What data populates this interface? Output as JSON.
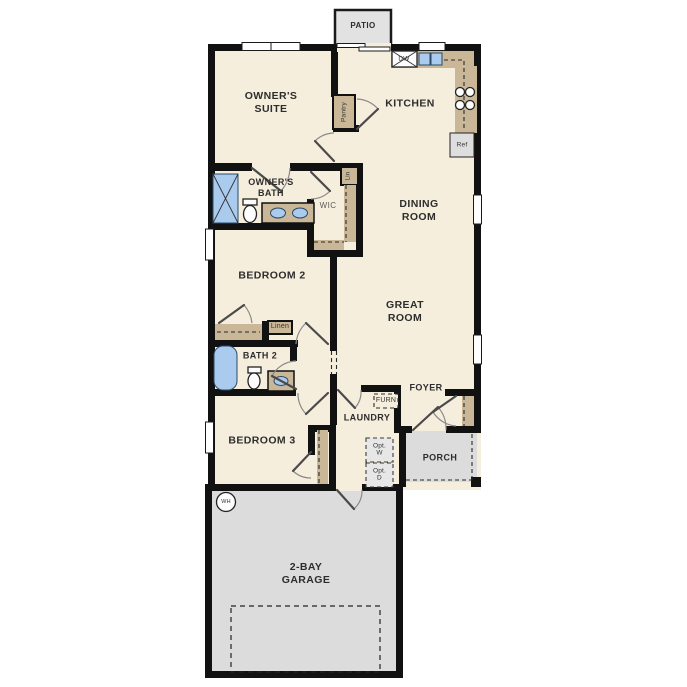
{
  "colors": {
    "wall": "#111111",
    "floor": "#f6eedd",
    "cabinet": "#c9b797",
    "fixture_blue": "#aacbee",
    "outdoor": "#e2e2e2",
    "garage": "#dcdcdc",
    "appliance": "#dedede",
    "optional_box": "#e7e7e7"
  },
  "rooms": {
    "patio": {
      "label": "PATIO"
    },
    "owners_suite": {
      "label": "OWNER'S\nSUITE"
    },
    "kitchen": {
      "label": "KITCHEN"
    },
    "owners_bath": {
      "label": "OWNER'S\nBATH"
    },
    "wic": {
      "label": "WIC"
    },
    "dining": {
      "label": "DINING\nROOM"
    },
    "bedroom2": {
      "label": "BEDROOM 2"
    },
    "bath2": {
      "label": "BATH 2"
    },
    "great_room": {
      "label": "GREAT\nROOM"
    },
    "foyer": {
      "label": "FOYER"
    },
    "laundry": {
      "label": "LAUNDRY"
    },
    "bedroom3": {
      "label": "BEDROOM 3"
    },
    "porch": {
      "label": "PORCH"
    },
    "garage": {
      "label": "2-BAY\nGARAGE"
    }
  },
  "fixtures": {
    "dishwasher": "DW",
    "refrigerator": "Ref",
    "pantry": "Pantry",
    "linen_small": "Lin",
    "linen": "Linen",
    "furnace": "FURN",
    "opt_washer": "Opt.\nW",
    "opt_dryer": "Opt.\nD",
    "water_heater": "WH"
  }
}
